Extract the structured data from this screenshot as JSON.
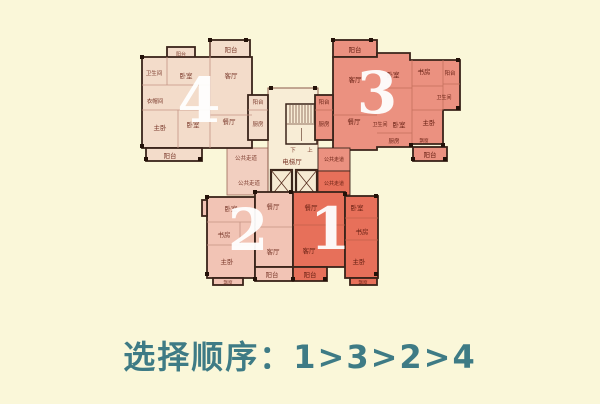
{
  "caption": "选择顺序：1>3>2>4",
  "colors": {
    "background": "#faf7d9",
    "wall": "#3a241a",
    "core": "#f8edd6",
    "corridor_light": "#f2cfc0",
    "unit1": "#e7705a",
    "unit2": "#f2c4b5",
    "unit3": "#eb9180",
    "unit4": "#f3dcca",
    "room_label": "#7b3a2c",
    "room_label_dark": "#661f12",
    "number": "#ffffff",
    "caption_color": "#3e7b85"
  },
  "plan": {
    "unit4": {
      "number": "4",
      "rooms": {
        "bath": "卫生间",
        "bed1": "卧室",
        "living": "客厅",
        "closet": "衣帽间",
        "master": "主卧",
        "bed2": "卧室",
        "dining": "餐厅",
        "balcony_top": "阳台",
        "balcony_window": "阳台",
        "balcony_bottom": "阳台",
        "balcony_side": "阳台",
        "kitchen": "厨房"
      }
    },
    "unit3": {
      "number": "3",
      "rooms": {
        "balcony_top": "阳台",
        "living": "客厅",
        "dining": "餐厅",
        "bed1": "卧室",
        "study": "书房",
        "balcony_right": "阳台",
        "bath1": "卫生间",
        "bath2": "卫生间",
        "bed2": "卧室",
        "master": "主卧",
        "kitchen": "厨房",
        "bay": "飘窗",
        "balcony_bottom": "阳台",
        "balcony_side": "阳台",
        "kitchen_side": "厨房",
        "corridor": "公共走道"
      }
    },
    "unit2": {
      "number": "2",
      "rooms": {
        "bed": "卧室",
        "dining": "餐厅",
        "study": "书房",
        "living": "客厅",
        "master": "主卧",
        "balcony": "阳台",
        "bay": "飘窗"
      }
    },
    "unit1": {
      "number": "1",
      "rooms": {
        "dining": "餐厅",
        "living": "客厅",
        "bed": "卧室",
        "study": "书房",
        "master": "主卧",
        "balcony": "阳台",
        "bay": "飘窗",
        "corridor": "公共走道"
      }
    },
    "core": {
      "elevator_hall": "电梯厅",
      "stair_down": "下",
      "stair_up": "上",
      "corridor_top": "公共走道",
      "corridor_bottom": "公共走道"
    }
  }
}
